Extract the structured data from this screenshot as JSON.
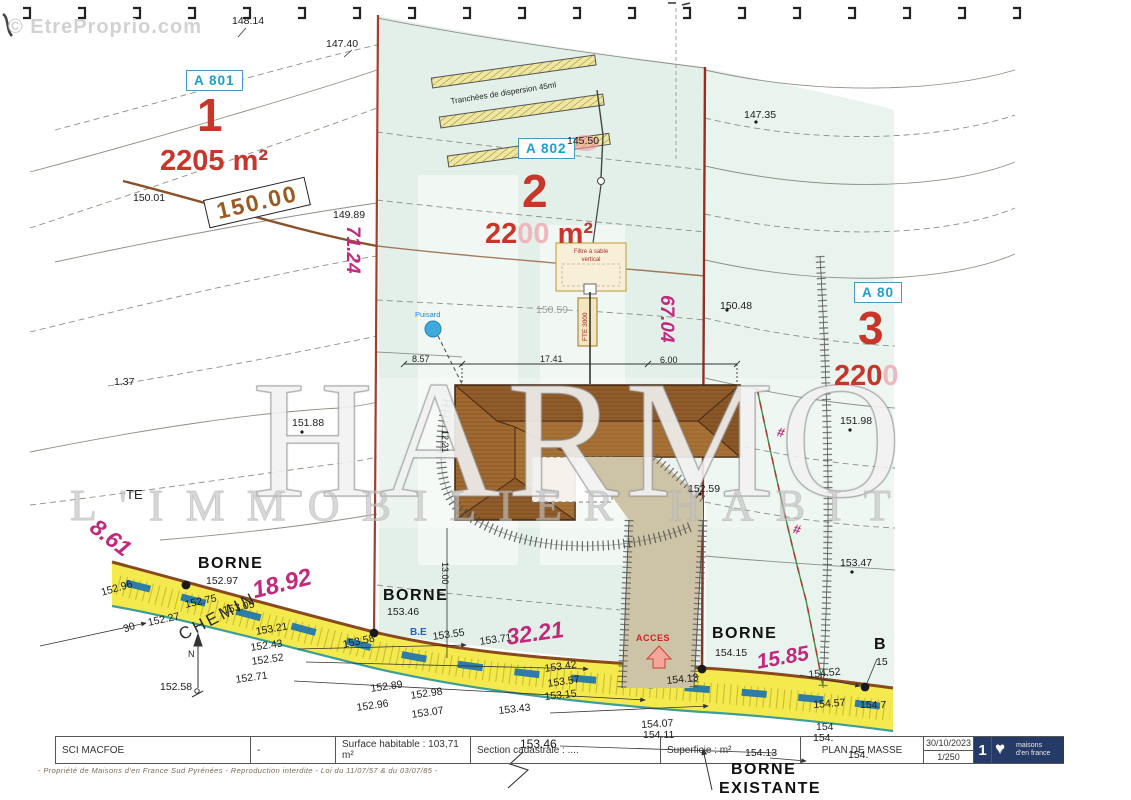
{
  "colors": {
    "magenta": "#c2297d",
    "lot_red": "#c8362b",
    "parcel_blue": "#1ba0cc",
    "road_yellow": "#f4ea4d",
    "plot_green": "#e2f0e9",
    "boundary_red": "#a63c2c",
    "navy": "#253a66",
    "roof_brown": "#a06a31"
  },
  "watermarks": {
    "source": "© EtreProprio.com",
    "agency_line1": "HARMON",
    "agency_line2": "L'IMMOBILIER HABITAT"
  },
  "lots": [
    {
      "parcel": "A 801",
      "number": "1",
      "area": "2205 m²"
    },
    {
      "parcel": "A 802",
      "number": "2",
      "area_prefix": "22",
      "area_faded": "00",
      "area_suffix": " m²"
    },
    {
      "parcel": "A 80",
      "number": "3",
      "area_prefix": "220",
      "area_faded": "0",
      "area_suffix": ""
    }
  ],
  "site_features": {
    "trench_caption": "Tranchées de dispersion 45ml",
    "filter_line1": "Filtre à sable",
    "filter_line2": "vertical",
    "tank_label": "FTE 3000",
    "soakaway_label": "Puisard",
    "access_label": "ACCES",
    "road_name": "CHEMIN",
    "contour_box_label": "150.00",
    "north_label": "N"
  },
  "labels": [
    {
      "t": "148.14",
      "x": 232,
      "y": 16,
      "k": "e"
    },
    {
      "t": "147.40",
      "x": 326,
      "y": 39,
      "k": "e"
    },
    {
      "t": "147.35",
      "x": 744,
      "y": 110,
      "k": "e"
    },
    {
      "t": "145.50",
      "x": 567,
      "y": 136,
      "k": "e"
    },
    {
      "t": "150.01",
      "x": 133,
      "y": 193,
      "k": "e"
    },
    {
      "t": "149.89",
      "x": 333,
      "y": 210,
      "k": "e"
    },
    {
      "t": "150.48",
      "x": 720,
      "y": 301,
      "k": "e"
    },
    {
      "t": "150.59",
      "x": 536,
      "y": 305,
      "k": "g"
    },
    {
      "t": "1.37",
      "x": 114,
      "y": 377,
      "k": "e"
    },
    {
      "t": "151.88",
      "x": 292,
      "y": 418,
      "k": "e"
    },
    {
      "t": "151.98",
      "x": 840,
      "y": 416,
      "k": "e"
    },
    {
      "t": "152.59",
      "x": 688,
      "y": 484,
      "k": "e"
    },
    {
      "t": "153.47",
      "x": 840,
      "y": 558,
      "k": "e"
    },
    {
      "t": "TE",
      "x": 126,
      "y": 488,
      "k": "t2"
    },
    {
      "t": "BORNE",
      "x": 198,
      "y": 556,
      "k": "b"
    },
    {
      "t": "152.97",
      "x": 206,
      "y": 576,
      "k": "e"
    },
    {
      "t": "BORNE",
      "x": 383,
      "y": 588,
      "k": "b"
    },
    {
      "t": "153.46",
      "x": 387,
      "y": 607,
      "k": "e"
    },
    {
      "t": "BORNE",
      "x": 712,
      "y": 626,
      "k": "b"
    },
    {
      "t": "154.15",
      "x": 715,
      "y": 648,
      "k": "e"
    },
    {
      "t": "B",
      "x": 874,
      "y": 637,
      "k": "b"
    },
    {
      "t": "15",
      "x": 876,
      "y": 657,
      "k": "e"
    },
    {
      "t": "B.E",
      "x": 410,
      "y": 628,
      "k": "be"
    },
    {
      "t": "153.55",
      "x": 432,
      "y": 632,
      "r": -8,
      "k": "e"
    },
    {
      "t": "153.71",
      "x": 479,
      "y": 637,
      "r": -8,
      "k": "e"
    },
    {
      "t": "152.96",
      "x": 100,
      "y": 588,
      "r": -16,
      "k": "e"
    },
    {
      "t": "152.75",
      "x": 184,
      "y": 600,
      "r": -12,
      "k": "e"
    },
    {
      "t": "153.05",
      "x": 222,
      "y": 606,
      "r": -12,
      "k": "e"
    },
    {
      "t": "152.27",
      "x": 147,
      "y": 618,
      "r": -12,
      "k": "e"
    },
    {
      "t": "153.21",
      "x": 255,
      "y": 627,
      "r": -10,
      "k": "e"
    },
    {
      "t": "152.43",
      "x": 250,
      "y": 643,
      "r": -8,
      "k": "e"
    },
    {
      "t": "152.52",
      "x": 251,
      "y": 657,
      "r": -8,
      "k": "e"
    },
    {
      "t": "152.71",
      "x": 235,
      "y": 675,
      "r": -8,
      "k": "e"
    },
    {
      "t": "152.58",
      "x": 160,
      "y": 682,
      "k": "e"
    },
    {
      "t": "30",
      "x": 122,
      "y": 625,
      "r": -20,
      "k": "e"
    },
    {
      "t": "153.58",
      "x": 342,
      "y": 640,
      "r": -12,
      "k": "e"
    },
    {
      "t": "153.42",
      "x": 544,
      "y": 664,
      "r": -8,
      "k": "e"
    },
    {
      "t": "153.57",
      "x": 547,
      "y": 679,
      "r": -8,
      "k": "e"
    },
    {
      "t": "153.15",
      "x": 544,
      "y": 692,
      "r": -6,
      "k": "e"
    },
    {
      "t": "153.43",
      "x": 498,
      "y": 706,
      "r": -6,
      "k": "e"
    },
    {
      "t": "152.89",
      "x": 370,
      "y": 684,
      "r": -8,
      "k": "e"
    },
    {
      "t": "152.98",
      "x": 410,
      "y": 691,
      "r": -8,
      "k": "e"
    },
    {
      "t": "152.96",
      "x": 356,
      "y": 703,
      "r": -8,
      "k": "e"
    },
    {
      "t": "153.07",
      "x": 411,
      "y": 710,
      "r": -8,
      "k": "e"
    },
    {
      "t": "153.46",
      "x": 520,
      "y": 738,
      "k": "e",
      "fs": 12
    },
    {
      "t": "154.13",
      "x": 666,
      "y": 676,
      "r": -6,
      "k": "e"
    },
    {
      "t": "154.52",
      "x": 808,
      "y": 670,
      "r": -6,
      "k": "e"
    },
    {
      "t": "154.57",
      "x": 813,
      "y": 700,
      "r": -4,
      "k": "e"
    },
    {
      "t": "154.7",
      "x": 860,
      "y": 700,
      "k": "e"
    },
    {
      "t": "154.07",
      "x": 641,
      "y": 720,
      "r": -3,
      "k": "e"
    },
    {
      "t": "154.11",
      "x": 643,
      "y": 730,
      "k": "e"
    },
    {
      "t": "154",
      "x": 816,
      "y": 722,
      "k": "e"
    },
    {
      "t": "154.",
      "x": 813,
      "y": 733,
      "k": "e"
    },
    {
      "t": "154.13",
      "x": 745,
      "y": 748,
      "k": "e"
    },
    {
      "t": "154.",
      "x": 848,
      "y": 750,
      "k": "e"
    },
    {
      "t": "BORNE",
      "x": 731,
      "y": 762,
      "k": "b"
    },
    {
      "t": "EXISTANTE",
      "x": 719,
      "y": 781,
      "k": "b"
    },
    {
      "t": "71.24",
      "x": 362,
      "y": 226,
      "r": 90,
      "k": "m",
      "fs": 19
    },
    {
      "t": "67.04",
      "x": 676,
      "y": 295,
      "r": 90,
      "k": "m",
      "fs": 19
    },
    {
      "t": "18.92",
      "x": 250,
      "y": 580,
      "r": -14,
      "k": "m",
      "fs": 24
    },
    {
      "t": "32.21",
      "x": 505,
      "y": 626,
      "r": -8,
      "k": "m",
      "fs": 23
    },
    {
      "t": "15.85",
      "x": 755,
      "y": 652,
      "r": -10,
      "k": "m",
      "fs": 21
    },
    {
      "t": "8.61",
      "x": 100,
      "y": 515,
      "r": 38,
      "k": "m",
      "fs": 23
    },
    {
      "t": "#",
      "x": 779,
      "y": 425,
      "r": 15,
      "k": "m",
      "fs": 13
    },
    {
      "t": "#",
      "x": 795,
      "y": 522,
      "r": 15,
      "k": "m",
      "fs": 13
    },
    {
      "t": "8.57",
      "x": 412,
      "y": 355,
      "k": "d"
    },
    {
      "t": "17.41",
      "x": 540,
      "y": 355,
      "k": "d"
    },
    {
      "t": "6.00",
      "x": 660,
      "y": 356,
      "k": "d"
    },
    {
      "t": "12.21",
      "x": 449,
      "y": 430,
      "r": 90,
      "k": "d"
    },
    {
      "t": "13.00",
      "x": 449,
      "y": 562,
      "r": 90,
      "k": "d"
    },
    {
      "t": "N",
      "x": 188,
      "y": 650,
      "k": "d"
    },
    {
      "t": "Tranchées de dispersion 45ml",
      "x": 450,
      "y": 98,
      "r": -9,
      "k": "t3"
    },
    {
      "t": "CHEMIN",
      "x": 176,
      "y": 628,
      "r": -27,
      "k": "chemin"
    },
    {
      "t": "ACCES",
      "x": 636,
      "y": 634,
      "k": "acces"
    },
    {
      "t": "Puisard",
      "x": 415,
      "y": 311,
      "k": "puisard"
    }
  ],
  "footer": {
    "owner": "SCI MACFOE",
    "dash": "-",
    "surface": "Surface habitable :  103,71 m²",
    "cadastre": "Section cadastrale : ....",
    "superficie": "Superficie :       m²",
    "doc_title": "PLAN DE MASSE",
    "date": "30/10/2023",
    "scale": "1/250",
    "page": "1",
    "logo_line1": "maisons",
    "logo_line2": "d'en france",
    "logo_heart": "♥",
    "logo_house": "⌂",
    "legal": "- Propriété de Maisons d'en France Sud Pyrénées - Reproduction interdite - Loi du 11/07/57 & du 03/07/85 -"
  }
}
